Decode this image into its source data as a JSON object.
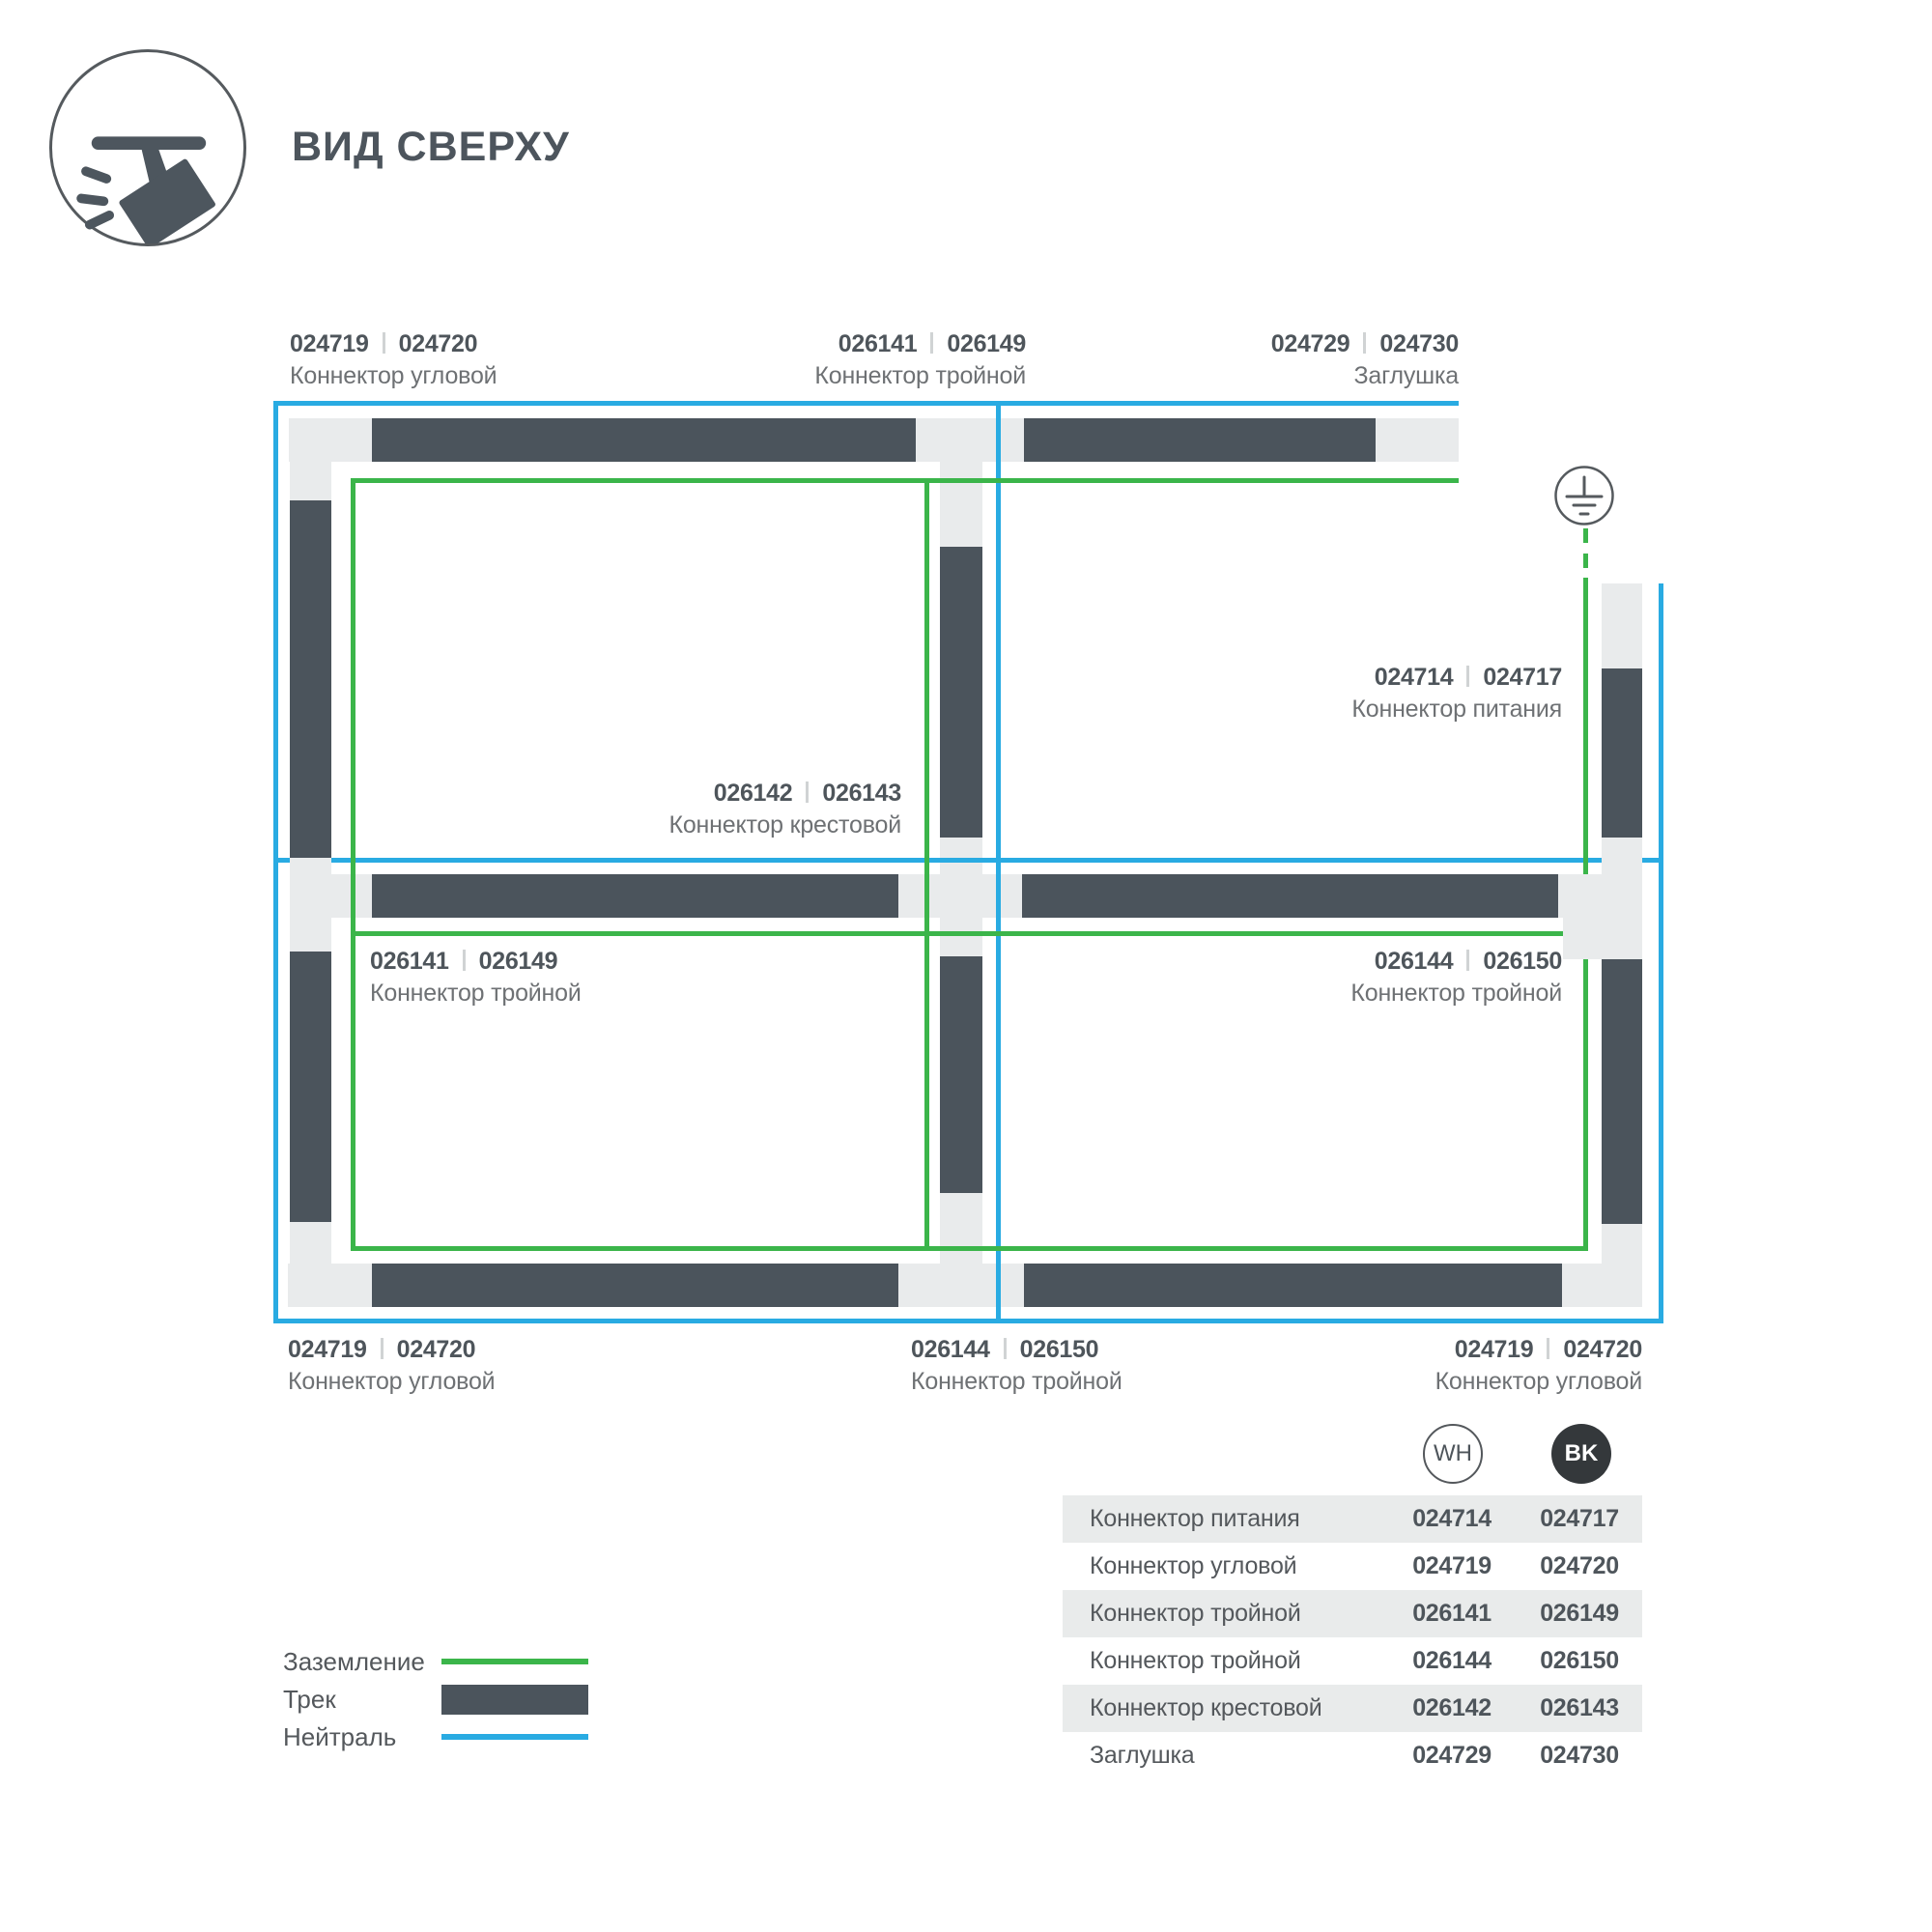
{
  "title": "ВИД СВЕРХУ",
  "colors": {
    "track": "#4b545c",
    "connector": "#e9ebec",
    "ground_green": "#3bb54a",
    "neutral_blue": "#29abe2",
    "badge_bk_fill": "#34383b"
  },
  "diagram": {
    "labels": [
      {
        "wh": "024719",
        "bk": "024720",
        "name": "Коннектор угловой"
      },
      {
        "wh": "026141",
        "bk": "026149",
        "name": "Коннектор тройной"
      },
      {
        "wh": "024729",
        "bk": "024730",
        "name": "Заглушка"
      },
      {
        "wh": "024714",
        "bk": "024717",
        "name": "Коннектор питания"
      },
      {
        "wh": "026142",
        "bk": "026143",
        "name": "Коннектор крестовой"
      },
      {
        "wh": "026141",
        "bk": "026149",
        "name": "Коннектор тройной"
      },
      {
        "wh": "026144",
        "bk": "026150",
        "name": "Коннектор тройной"
      },
      {
        "wh": "024719",
        "bk": "024720",
        "name": "Коннектор угловой"
      },
      {
        "wh": "026144",
        "bk": "026150",
        "name": "Коннектор тройной"
      },
      {
        "wh": "024719",
        "bk": "024720",
        "name": "Коннектор угловой"
      }
    ]
  },
  "legend": {
    "items": [
      {
        "label": "Заземление"
      },
      {
        "label": "Трек"
      },
      {
        "label": "Нейтраль"
      }
    ]
  },
  "swatches": {
    "wh": "WH",
    "bk": "BK"
  },
  "table": {
    "rows": [
      {
        "name": "Коннектор питания",
        "wh": "024714",
        "bk": "024717"
      },
      {
        "name": "Коннектор угловой",
        "wh": "024719",
        "bk": "024720"
      },
      {
        "name": "Коннектор тройной",
        "wh": "026141",
        "bk": "026149"
      },
      {
        "name": "Коннектор тройной",
        "wh": "026144",
        "bk": "026150"
      },
      {
        "name": "Коннектор крестовой",
        "wh": "026142",
        "bk": "026143"
      },
      {
        "name": "Заглушка",
        "wh": "024729",
        "bk": "024730"
      }
    ]
  }
}
